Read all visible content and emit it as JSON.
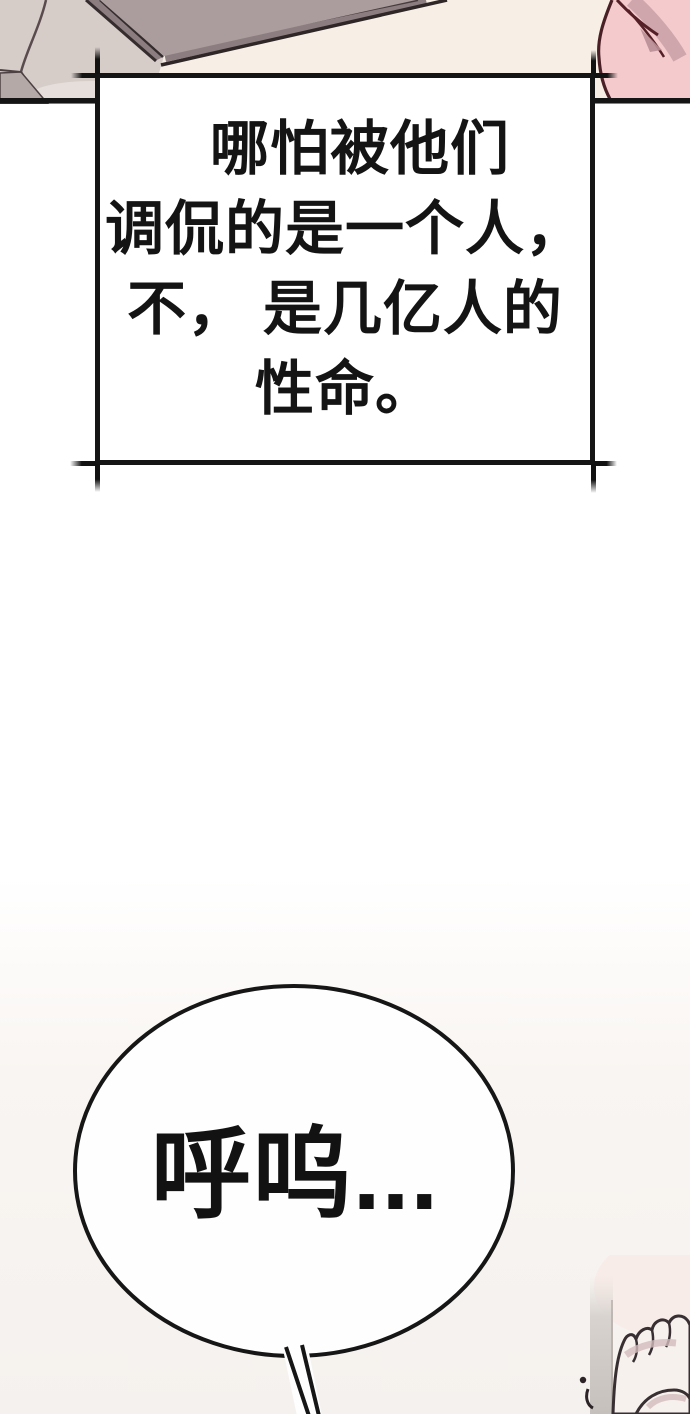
{
  "panel": {
    "kind": "comic-page"
  },
  "narration": {
    "lines": [
      "哪怕被他们",
      "调侃的是一个人，",
      "不， 是几亿人的",
      "性命。"
    ]
  },
  "speech": {
    "text": "呼呜..."
  },
  "colors": {
    "page_white": "#ffffff",
    "warm_white_bottom": "#f5f1ee",
    "cream_background": "#f7efe6",
    "pink_fabric": "#f4cacd",
    "pink_outline": "#4a2026",
    "gray_fabric": "#d6cdc9",
    "tablet_face": "#ab9d9e",
    "tablet_edge": "#8c7e80",
    "ink_line": "#151515",
    "skin_highlight": "#f7f1ed",
    "skin_shadow": "#d2bcbc",
    "pole_gray": "#ccc6c2"
  }
}
